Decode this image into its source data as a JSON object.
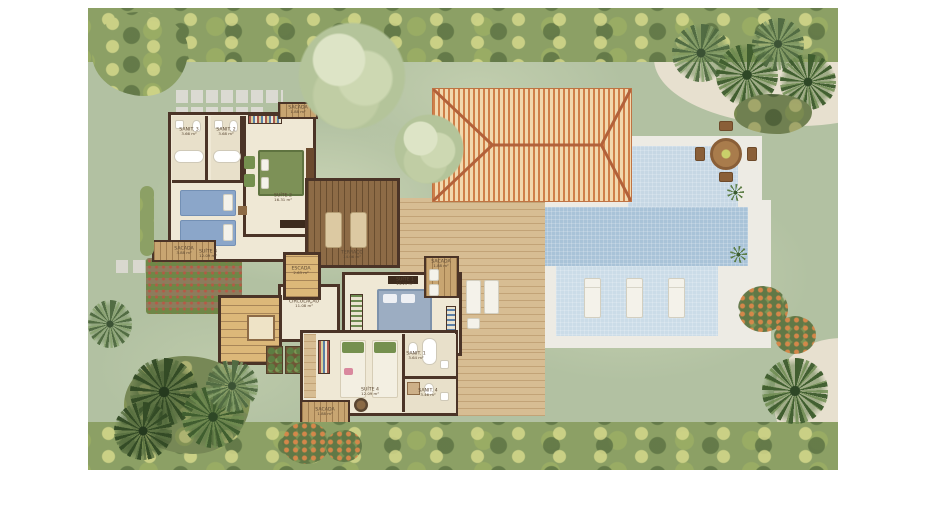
{
  "plan_type": "residential floor plan with pool and garden",
  "rooms": {
    "suite1": {
      "name": "SUÍTE 1",
      "area": "14.21 m²"
    },
    "suite2": {
      "name": "SUÍTE 2",
      "area": "16.31 m²"
    },
    "suite3": {
      "name": "SUÍTE 3",
      "area": "12.09 m²"
    },
    "suite4": {
      "name": "SUÍTE 4",
      "area": "12.09 m²"
    },
    "sanit1": {
      "name": "SANIT. 1",
      "area": "3.64 m²"
    },
    "sanit2": {
      "name": "SANIT. 2",
      "area": "3.68 m²"
    },
    "sanit3": {
      "name": "SANIT. 3",
      "area": "3.66 m²"
    },
    "sanit4": {
      "name": "SANIT. 4",
      "area": "3.46 m²"
    },
    "terraco": {
      "name": "TERRAÇO",
      "area": "14.06 m²"
    },
    "escada": {
      "name": "ESCADA",
      "area": "2.63 m²"
    },
    "circulacao": {
      "name": "CIRCULAÇÃO",
      "area": "11.08 m²"
    },
    "sacada_suite2": {
      "name": "SACADA",
      "area": "1.88 m²"
    },
    "sacada_suite3": {
      "name": "SACADA",
      "area": "3.88 m²"
    },
    "sacada_suite1": {
      "name": "SACADA",
      "area": "1.88 m²"
    },
    "sacada_suite4": {
      "name": "SACADA",
      "area": "1.88 m²"
    }
  },
  "palette": {
    "lawn": "#b2c1a2",
    "hedge": "#8ca065",
    "sand": "#e7e0cf",
    "wall": "#4b3427",
    "floor": "#efe8d5",
    "bath_floor": "#e8e0ca",
    "wood_light": "#d7bd93",
    "wood_dark": "#8d6b46",
    "roof_a": "#cf7f49",
    "roof_b": "#f2d8ad",
    "roof_ridge": "#b2613a",
    "pool_upper": "#c6d7e4",
    "pool_main": "#a9c3d8",
    "pool_shelf": "#cbdce8",
    "pool_deck": "#edebe4",
    "bed_blue": "#8ba6c9",
    "bed_gray": "#9cadc2",
    "green_furn": "#75904f",
    "white_furn": "#f4f2ea",
    "label": "#5a4733"
  }
}
